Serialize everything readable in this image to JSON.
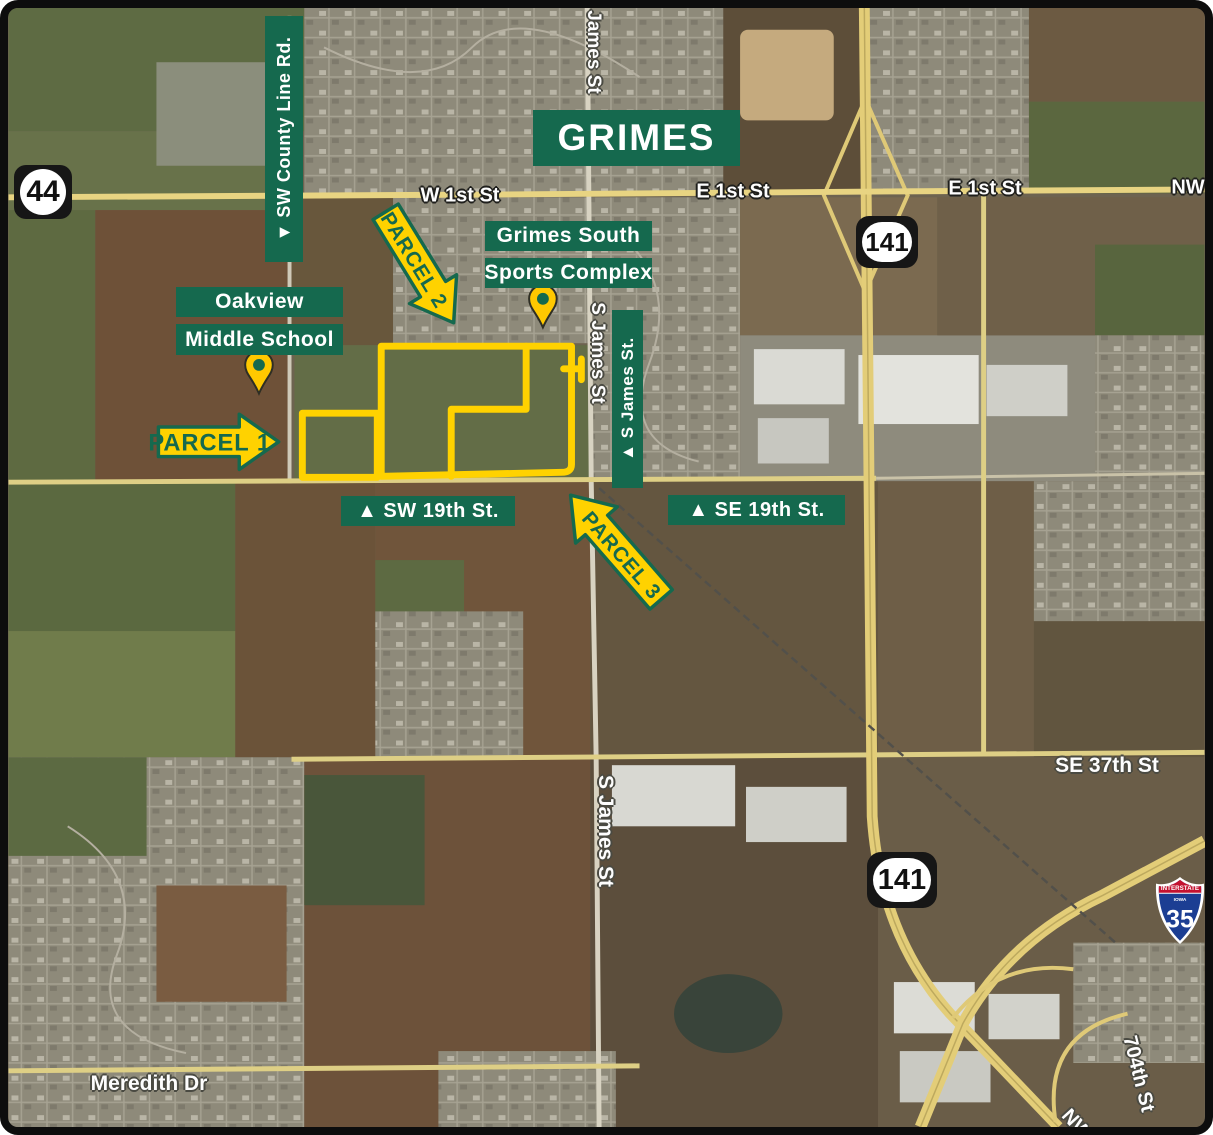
{
  "city": {
    "name": "GRIMES"
  },
  "shields": {
    "route_44": "44",
    "route_141_top": "141",
    "route_141_bottom": "141",
    "i35": {
      "banner": "INTERSTATE",
      "state": "IOWA",
      "number": "35"
    }
  },
  "callouts": {
    "sw_county_line_rd": "▼ SW County Line Rd.",
    "oakview_line1": "Oakview",
    "oakview_line2": "Middle School",
    "grimes_south_line1": "Grimes South",
    "grimes_south_line2": "Sports Complex",
    "sw_19th_st": "▲ SW 19th St.",
    "se_19th_st": "▲ SE 19th St.",
    "s_james_st": "▲ S James St."
  },
  "parcels": {
    "parcel1": "PARCEL 1",
    "parcel2": "PARCEL 2",
    "parcel3": "PARCEL 3"
  },
  "streets": {
    "w_1st_st": "W 1st St",
    "e_1st_st_west": "E 1st St",
    "e_1st_st_east": "E 1st St",
    "nw_top": "NW",
    "james_st_top": "James St",
    "s_james_st_mid": "S James St",
    "s_james_st_south": "S James St",
    "se_37th_st": "SE 37th St",
    "meredith_dr": "Meredith Dr",
    "st_704th": "704th St",
    "nw_bottom": "NW"
  },
  "colors": {
    "label_green": "#15694E",
    "highlight_yellow": "#FFD200",
    "shield_black": "#161616",
    "interstate_red": "#C41230",
    "interstate_blue": "#1C3E93"
  }
}
